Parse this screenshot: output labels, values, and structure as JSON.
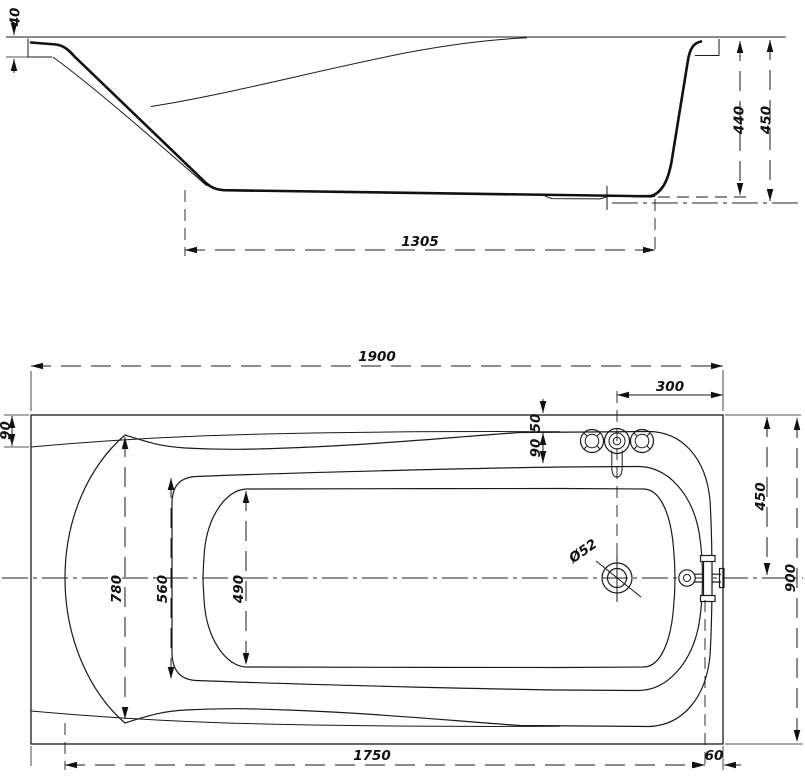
{
  "drawing": {
    "side_view": {
      "lip_height": "40",
      "inner_depth": "440",
      "overall_height": "450",
      "bottom_length": "1305"
    },
    "plan_view": {
      "overall_length": "1900",
      "faucet_spacing": "300",
      "rim_offset_top": "50",
      "rim_offset_inner": "90",
      "head_rim_offset": "90",
      "opening_width": "780",
      "mid_width": "560",
      "bottom_width": "490",
      "half_width": "450",
      "overall_width": "900",
      "drain_diameter": "Ø52",
      "bottom_length": "1750",
      "overflow_offset": "60"
    }
  }
}
